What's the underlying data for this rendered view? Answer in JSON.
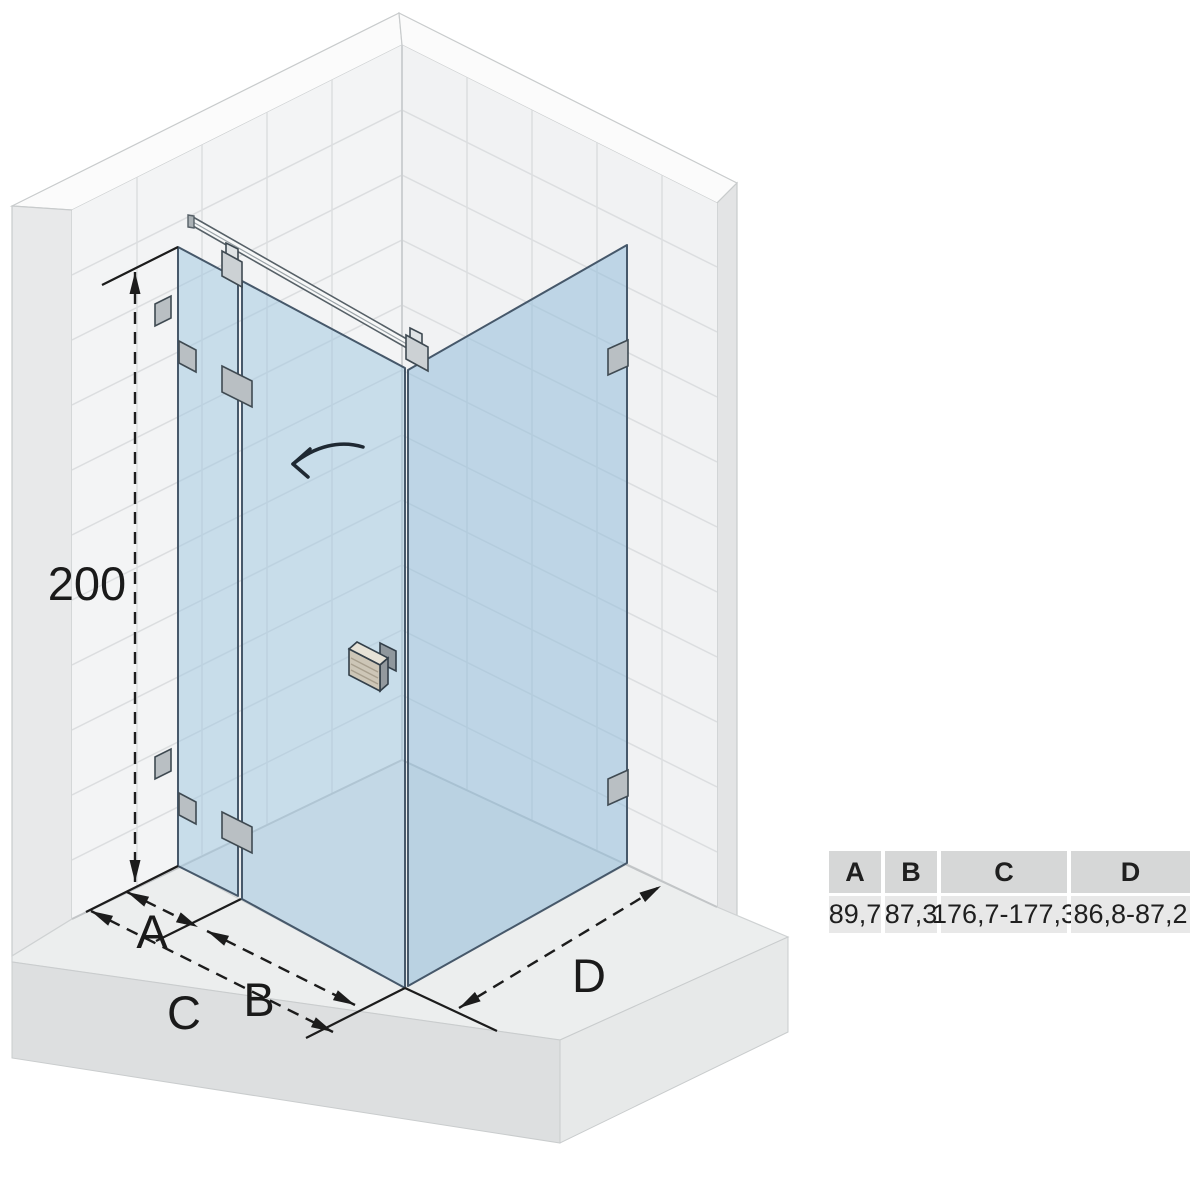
{
  "diagram": {
    "height_label": "200",
    "dim_labels": {
      "a": "A",
      "b": "B",
      "c": "C",
      "d": "D"
    },
    "colors": {
      "glass": "#c9dcea",
      "glass_edge": "#46586a",
      "wall_tile": "#f3f4f5",
      "grout_line": "#dcdee0",
      "floor_top": "#eceeee",
      "floor_face": "#dddfe0",
      "hardware_gray": "#b9bfc3",
      "handle_beige": "#cdc6b7",
      "annotation_line": "#1c1c1c"
    }
  },
  "table": {
    "headers": [
      "A",
      "B",
      "C",
      "D"
    ],
    "values": [
      "89,7",
      "87,3",
      "176,7-177,3",
      "86,8-87,2"
    ]
  }
}
